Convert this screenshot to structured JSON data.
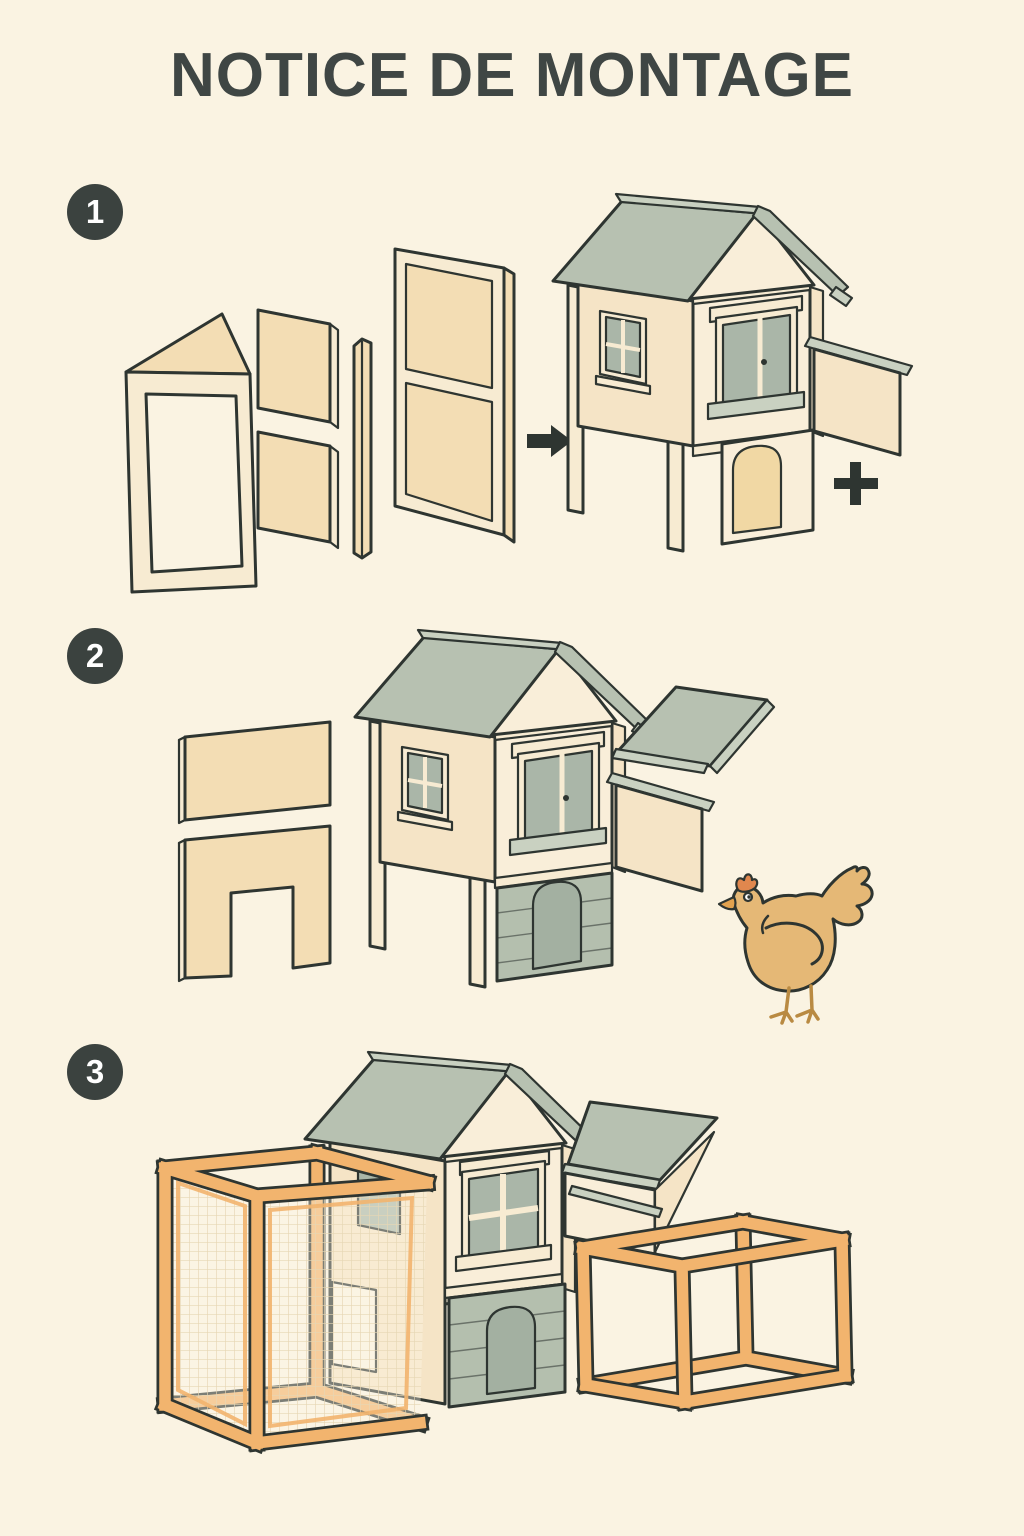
{
  "page": {
    "title": "NOTICE DE MONTAGE"
  },
  "palette": {
    "background": "#faf3e2",
    "title_text": "#3f4644",
    "outline": "#2e3531",
    "badge": "#3b423f",
    "badge_text": "#ffffff",
    "wood_tan": "#f3ddb4",
    "wood_cream": "#f7ebd2",
    "wood_light": "#fbf2e0",
    "wall": "#f5e4c6",
    "wall_front": "#f9eed9",
    "roof_sage": "#b7c1b1",
    "roof_cap": "#c9d1c1",
    "window_sage": "#aab6a8",
    "plank_sage": "#b4bfae",
    "door_sage": "#a3b0a1",
    "door_tan": "#f1d8a4",
    "frame_orange": "#f2b46e",
    "mesh_line": "#e6d6b4",
    "chicken_body": "#e5b876",
    "chicken_comb": "#e0874e",
    "chicken_beak": "#e2a24f",
    "chicken_leg": "#b98a42"
  },
  "steps": [
    {
      "number": "1",
      "name": "assemble-side-panels-into-coop-body",
      "symbols": [
        "arrow-right",
        "plus"
      ]
    },
    {
      "number": "2",
      "name": "attach-back-wall-doorway-panel-and-roof-panel",
      "extra": "chicken"
    },
    {
      "number": "3",
      "name": "attach-wire-mesh-run-frames"
    }
  ]
}
